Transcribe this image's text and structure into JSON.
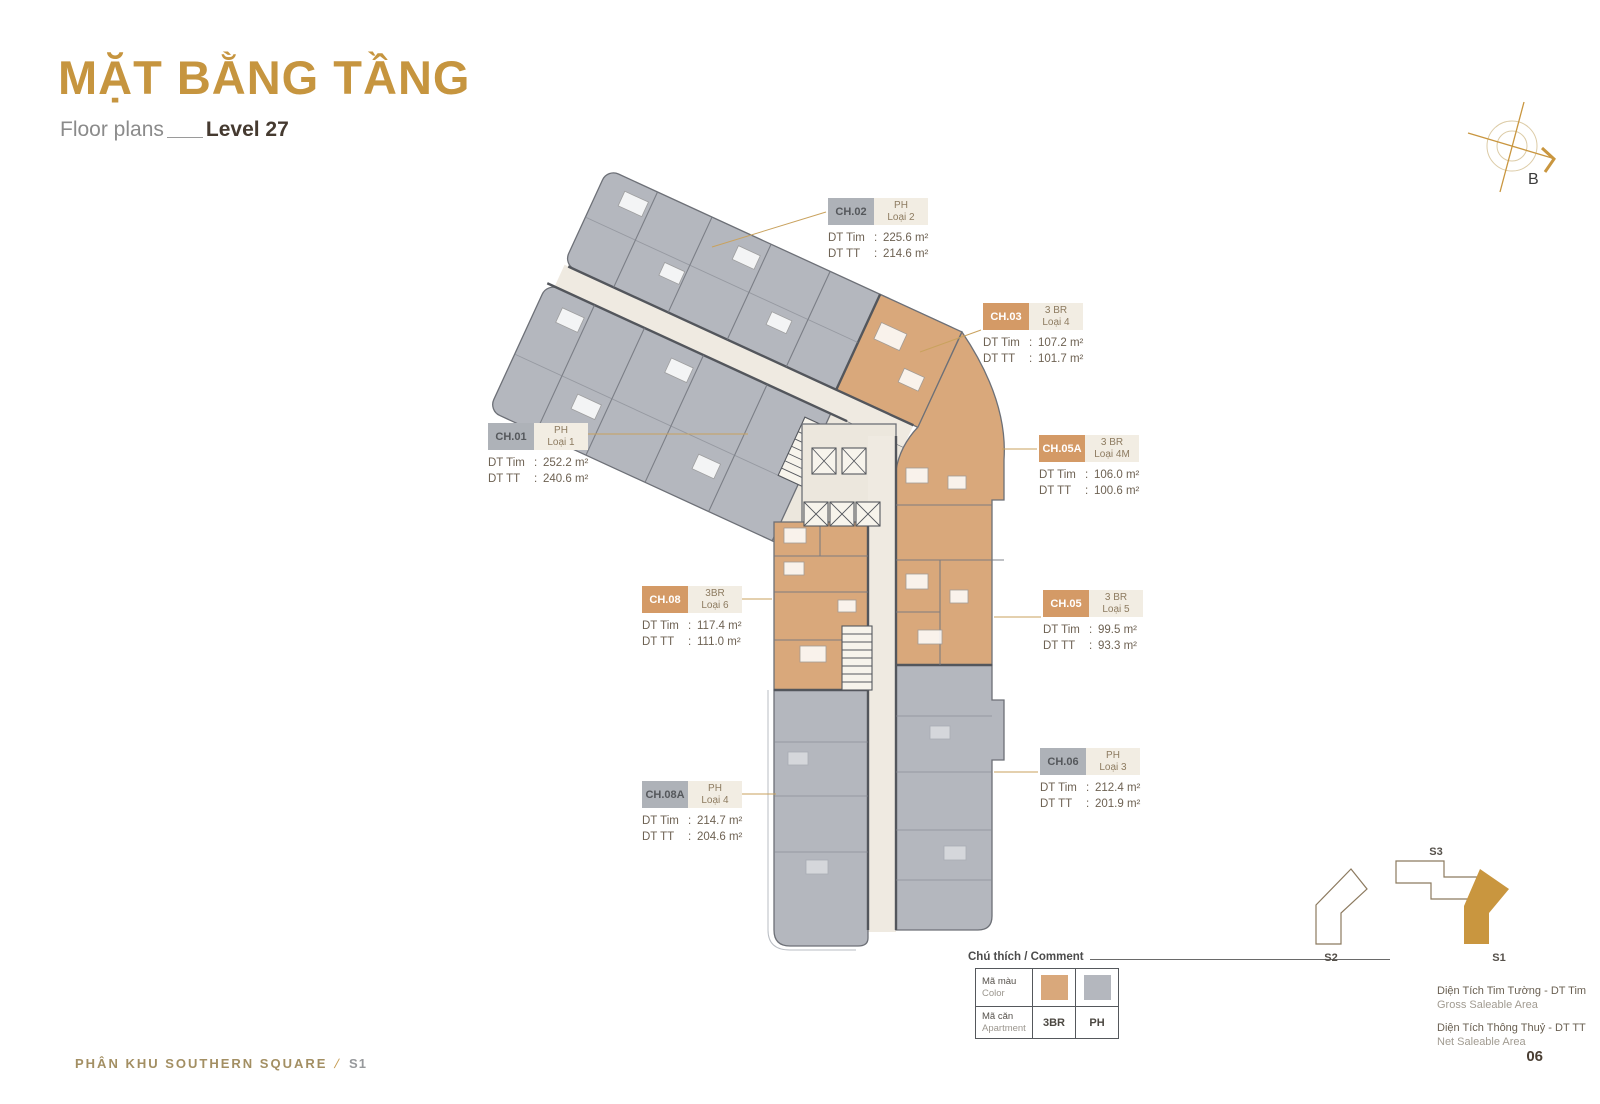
{
  "header": {
    "title": "MẶT BẰNG TẦNG",
    "subtitle": "Floor plans",
    "level": "Level 27"
  },
  "compass": {
    "label": "B"
  },
  "labels": {
    "dt_tim": "DT Tim",
    "dt_tt": "DT TT",
    "colon": ":"
  },
  "units": [
    {
      "code": "CH.02",
      "kind": "PH",
      "variant": "Loại 2",
      "gross": "225.6 m²",
      "net": "214.6 m²",
      "color": "gray"
    },
    {
      "code": "CH.03",
      "kind": "3 BR",
      "variant": "Loại 4",
      "gross": "107.2 m²",
      "net": "101.7 m²",
      "color": "tan"
    },
    {
      "code": "CH.01",
      "kind": "PH",
      "variant": "Loại 1",
      "gross": "252.2 m²",
      "net": "240.6 m²",
      "color": "gray"
    },
    {
      "code": "CH.05A",
      "kind": "3 BR",
      "variant": "Loại 4M",
      "gross": "106.0 m²",
      "net": "100.6 m²",
      "color": "tan"
    },
    {
      "code": "CH.08",
      "kind": "3BR",
      "variant": "Loại 6",
      "gross": "117.4 m²",
      "net": "111.0 m²",
      "color": "tan"
    },
    {
      "code": "CH.05",
      "kind": "3 BR",
      "variant": "Loại 5",
      "gross": "99.5 m²",
      "net": "93.3 m²",
      "color": "tan"
    },
    {
      "code": "CH.06",
      "kind": "PH",
      "variant": "Loại 3",
      "gross": "212.4 m²",
      "net": "201.9 m²",
      "color": "gray"
    },
    {
      "code": "CH.08A",
      "kind": "PH",
      "variant": "Loại 4",
      "gross": "214.7 m²",
      "net": "204.6 m²",
      "color": "gray"
    }
  ],
  "legend": {
    "title": "Chú thích / Comment",
    "rows": [
      {
        "vi": "Mã màu",
        "en": "Color"
      },
      {
        "vi": "Mã căn",
        "en": "Apartment"
      }
    ],
    "apartment_types": [
      "3BR",
      "PH"
    ],
    "colors": {
      "tan": "#d9a87b",
      "gray": "#b4b7be"
    },
    "area_defs": [
      {
        "vi": "Diện Tích Tim Tường - DT Tim",
        "en": "Gross Saleable Area"
      },
      {
        "vi": "Diện Tích Thông Thuỷ - DT TT",
        "en": "Net Saleable Area"
      }
    ]
  },
  "minimap": {
    "buildings": [
      {
        "id": "S3",
        "active": false
      },
      {
        "id": "S2",
        "active": false
      },
      {
        "id": "S1",
        "active": true
      }
    ],
    "active_color": "#C9963F"
  },
  "footer": {
    "left": "PHÂN KHU SOUTHERN SQUARE",
    "separator": "/",
    "section": "S1",
    "page": "06"
  }
}
